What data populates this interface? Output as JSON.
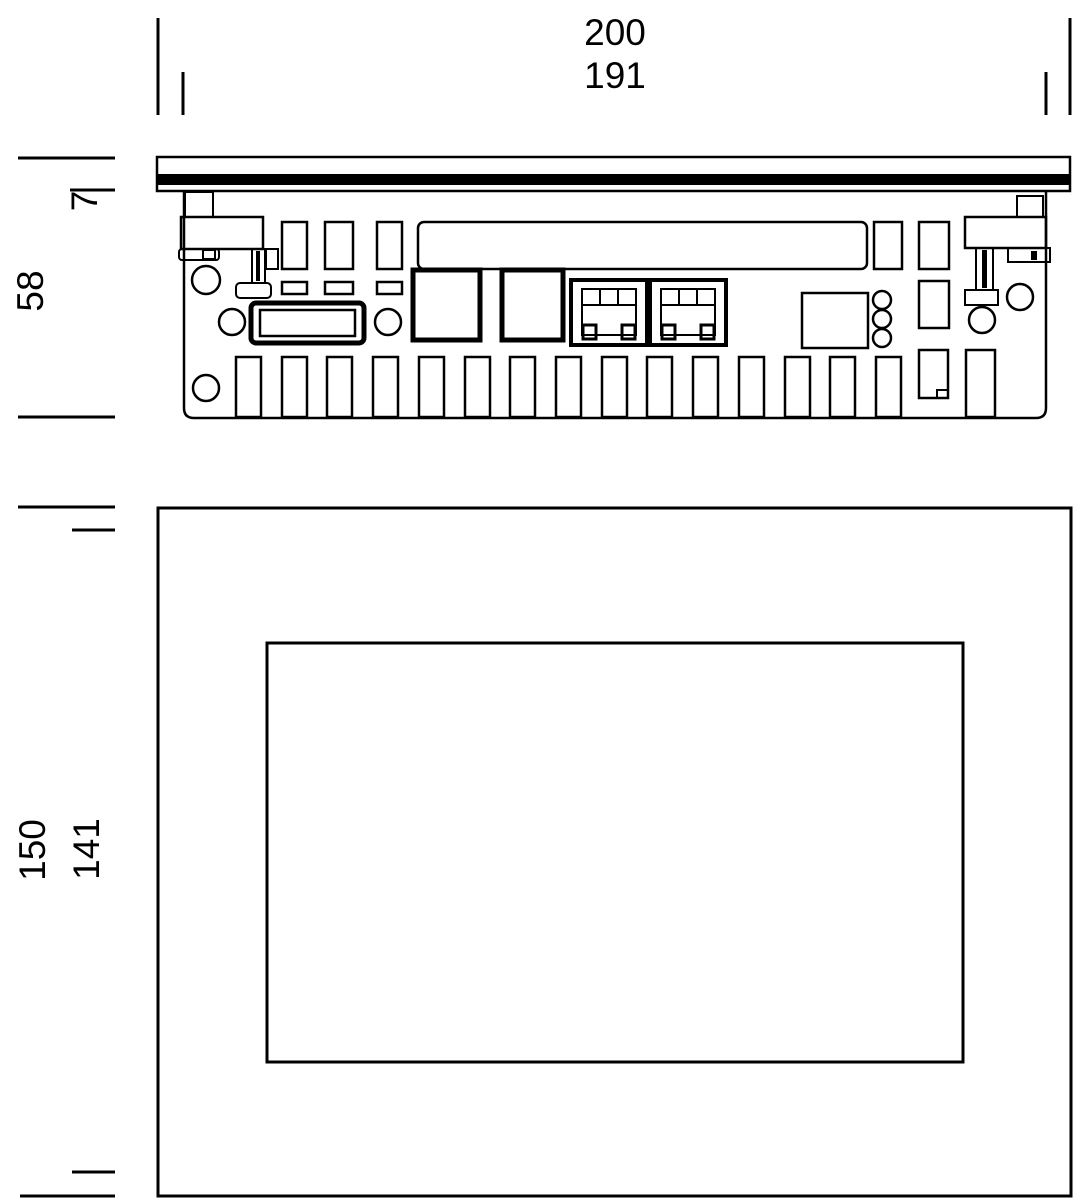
{
  "dimensions": {
    "width_outer": "200",
    "width_inner": "191",
    "bezel_depth": "7",
    "total_depth": "58",
    "height_outer": "150",
    "height_inner": "141"
  },
  "colors": {
    "line": "#000000",
    "background": "#ffffff"
  }
}
